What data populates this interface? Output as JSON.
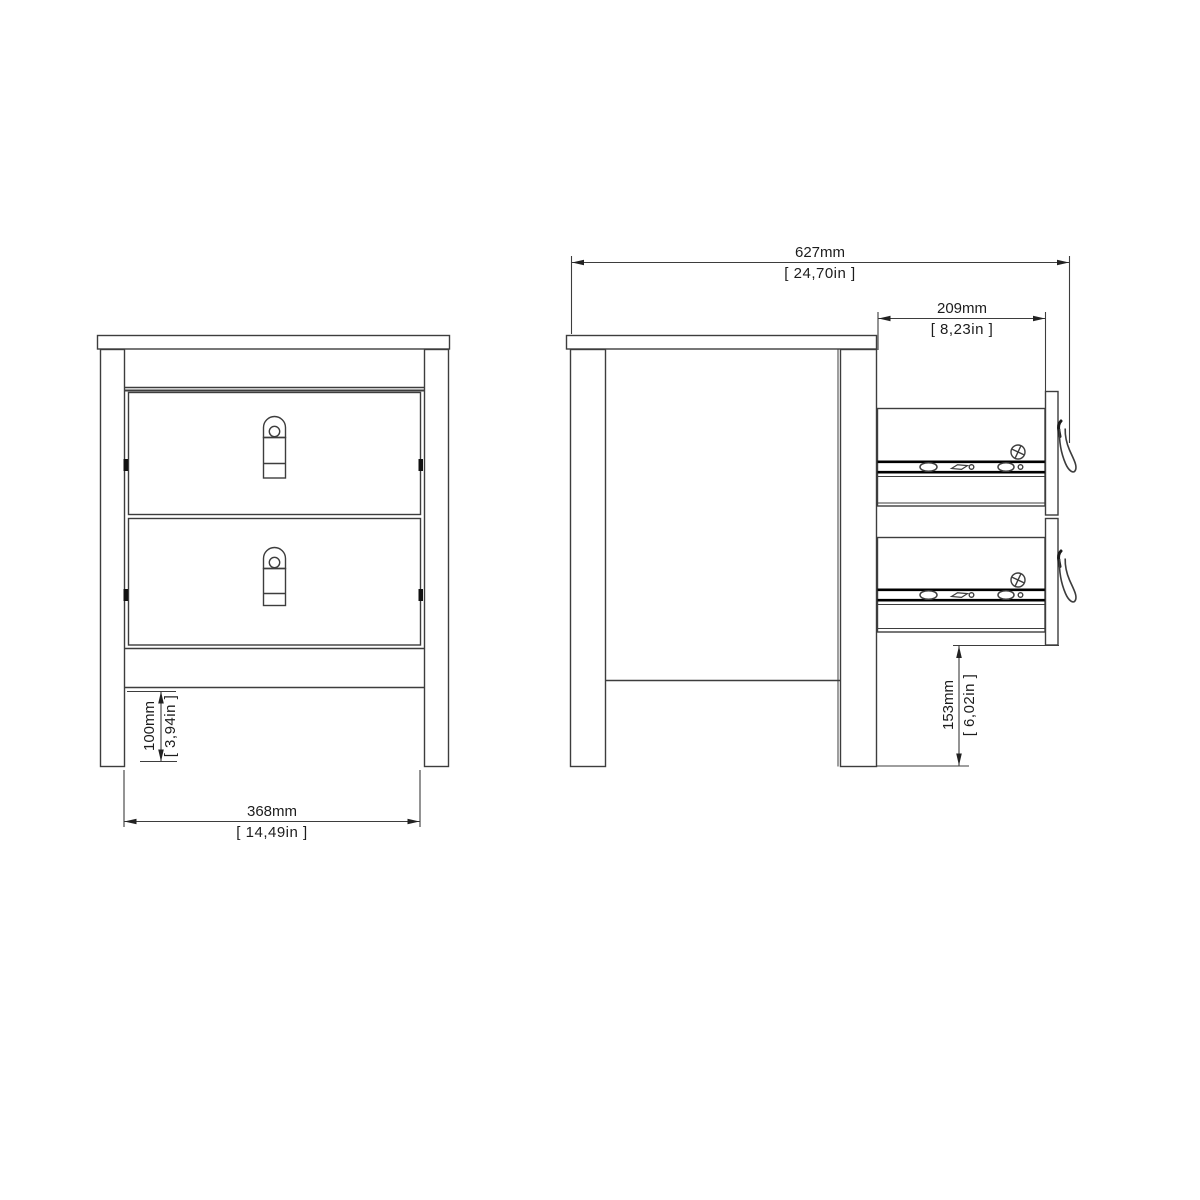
{
  "views": {
    "front": {
      "dimensions": {
        "leg_height": {
          "mm": "100mm",
          "in": "[ 3,94in ]"
        },
        "width": {
          "mm": "368mm",
          "in": "[ 14,49in ]"
        }
      }
    },
    "side": {
      "dimensions": {
        "total_depth": {
          "mm": "627mm",
          "in": "[ 24,70in ]"
        },
        "drawer_depth": {
          "mm": "209mm",
          "in": "[ 8,23in ]"
        },
        "under_drawer_clearance": {
          "mm": "153mm",
          "in": "[ 6,02in ]"
        }
      }
    }
  },
  "icons": {
    "screw": "phillips-screw-icon",
    "front_handle": "strap-handle-front-icon",
    "side_handle": "strap-handle-side-icon",
    "drawer_rail": "drawer-slide-rail"
  },
  "colors": {
    "background": "#ffffff",
    "line": "#3d3d3d",
    "thick_line": "#000000",
    "text": "#1d1d1d"
  }
}
